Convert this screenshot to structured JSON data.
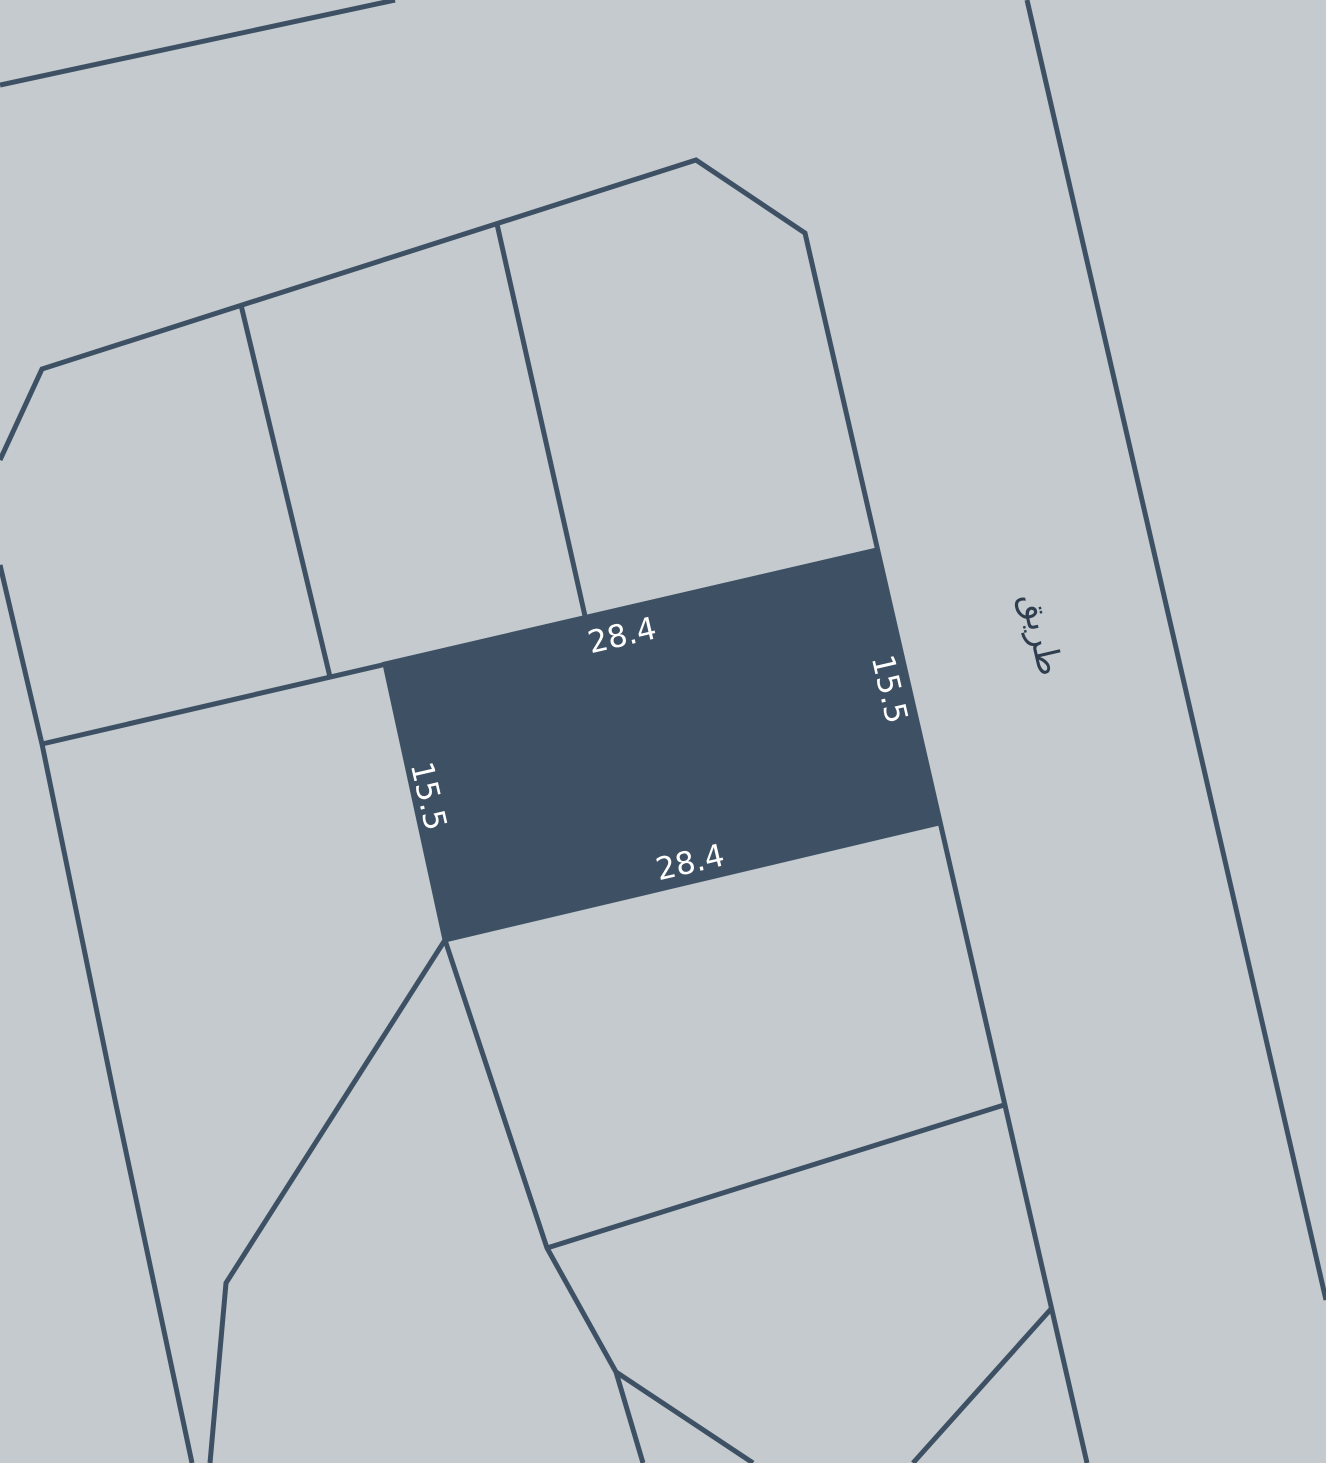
{
  "map": {
    "background_color": "#c4cace",
    "line_color": "#3e5164",
    "parcel_fill": "#3e5063",
    "dimension_label_color": "#ffffff",
    "road_label_color": "#2f3e4f",
    "highlighted_parcel": {
      "top_dimension": "28.4",
      "bottom_dimension": "28.4",
      "left_dimension": "15.5",
      "right_dimension": "15.5"
    },
    "road": {
      "label": "طريق"
    }
  }
}
